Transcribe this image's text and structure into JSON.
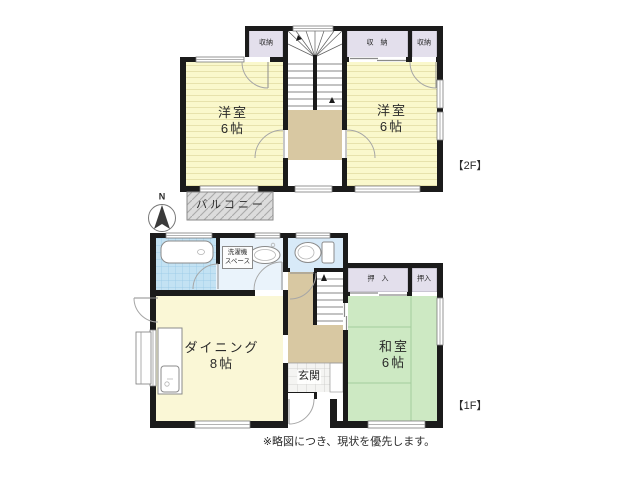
{
  "note": "※略図につき、現状を優先します。",
  "compass": {
    "north_label": "N"
  },
  "f2": {
    "floor_label": "【2F】",
    "left_room": {
      "name": "洋室",
      "size": "6帖"
    },
    "right_room": {
      "name": "洋室",
      "size": "6帖"
    },
    "closet_left": {
      "label": "収納"
    },
    "closet_wide": {
      "label": "収　納"
    },
    "closet_narrow": {
      "label": "収納"
    },
    "balcony": {
      "label": "バルコニー"
    }
  },
  "f1": {
    "floor_label": "【1F】",
    "dining": {
      "name": "ダイニング",
      "size": "8帖"
    },
    "japanese_room": {
      "name": "和室",
      "size": "6帖"
    },
    "entrance": {
      "label": "玄関"
    },
    "laundry": {
      "line1": "洗濯機",
      "line2": "スペース"
    },
    "oshiire_wide": {
      "label": "押　入"
    },
    "oshiire_narrow": {
      "label": "押入"
    }
  },
  "colors": {
    "wall": "#1b1b1b",
    "western_room": "#faf8cc",
    "dining_room": "#faf7d6",
    "tatami_room": "#cde9c3",
    "closet": "#e3dfec",
    "hall": "#d8c8a2",
    "balcony": "#dcdcdc",
    "bath_tile": "#c3e2f3",
    "washroom_floor": "#eaf3fb",
    "toilet_floor": "#d8eaf8"
  }
}
